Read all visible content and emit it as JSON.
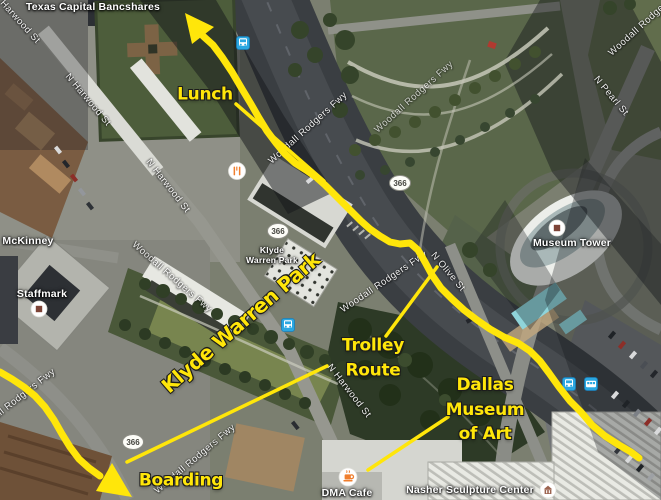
{
  "yellow_color": "#ffe60a",
  "annotations": {
    "labels": [
      {
        "id": "lunch-annotation",
        "text": "Lunch",
        "x": 205,
        "y": 95,
        "size": 17,
        "rot": 0
      },
      {
        "id": "klyde-warren-park-annotation",
        "text": "Klyde Warren Park",
        "x": 241,
        "y": 323,
        "size": 20,
        "rot": -41,
        "ls": -0.5
      },
      {
        "id": "trolley-route-annotation",
        "text": "Trolley\nRoute",
        "x": 373,
        "y": 358,
        "size": 17,
        "rot": 0
      },
      {
        "id": "dallas-museum-of-art-annotation",
        "text": "Dallas\nMuseum\nof Art",
        "x": 485,
        "y": 410,
        "size": 17,
        "rot": 0
      },
      {
        "id": "boarding-annotation",
        "text": "Boarding",
        "x": 181,
        "y": 481,
        "size": 17,
        "rot": 0
      }
    ],
    "routes": [
      {
        "id": "lunch-leader-line",
        "width": 3.5,
        "points": [
          [
            236,
            104
          ],
          [
            324,
            181
          ]
        ]
      },
      {
        "id": "trolley-route-line",
        "width": 3.5,
        "points": [
          [
            327,
            366
          ],
          [
            127,
            462
          ]
        ]
      },
      {
        "id": "trolley-leader-line",
        "width": 3.5,
        "points": [
          [
            437,
            267
          ],
          [
            386,
            336
          ]
        ]
      },
      {
        "id": "dma-leader-line",
        "width": 3.5,
        "points": [
          [
            448,
            417
          ],
          [
            368,
            470
          ]
        ]
      },
      {
        "id": "main-walking-route",
        "width": 7,
        "points": [
          [
            203,
            36
          ],
          [
            213,
            45
          ],
          [
            222,
            57
          ],
          [
            232,
            72
          ],
          [
            242,
            89
          ],
          [
            251,
            104
          ],
          [
            259,
            118
          ],
          [
            267,
            131
          ],
          [
            276,
            143
          ],
          [
            285,
            154
          ],
          [
            295,
            163
          ],
          [
            306,
            170
          ],
          [
            316,
            177
          ],
          [
            325,
            185
          ],
          [
            334,
            194
          ],
          [
            343,
            203
          ],
          [
            352,
            212
          ],
          [
            361,
            221
          ],
          [
            370,
            229
          ],
          [
            380,
            236
          ],
          [
            390,
            242
          ],
          [
            400,
            244
          ],
          [
            410,
            243
          ],
          [
            418,
            250
          ],
          [
            425,
            262
          ],
          [
            432,
            275
          ],
          [
            441,
            288
          ],
          [
            452,
            299
          ],
          [
            464,
            310
          ],
          [
            477,
            320
          ],
          [
            490,
            329
          ],
          [
            504,
            337
          ],
          [
            518,
            343
          ],
          [
            530,
            351
          ],
          [
            540,
            361
          ],
          [
            549,
            373
          ],
          [
            559,
            387
          ],
          [
            570,
            401
          ],
          [
            581,
            412
          ],
          [
            592,
            425
          ],
          [
            605,
            436
          ],
          [
            619,
            445
          ],
          [
            631,
            452
          ],
          [
            639,
            458
          ]
        ]
      },
      {
        "id": "boarding-route",
        "width": 7,
        "points": [
          [
            0,
            372
          ],
          [
            12,
            379
          ],
          [
            24,
            387
          ],
          [
            35,
            396
          ],
          [
            45,
            407
          ],
          [
            54,
            420
          ],
          [
            62,
            434
          ],
          [
            70,
            447
          ],
          [
            79,
            459
          ],
          [
            89,
            468
          ],
          [
            100,
            476
          ]
        ]
      }
    ],
    "arrowheads": [
      {
        "id": "north-arrowhead",
        "points": [
          [
            185,
            13
          ],
          [
            214,
            27
          ],
          [
            192,
            44
          ]
        ]
      },
      {
        "id": "boarding-arrowhead",
        "points": [
          [
            132,
            497
          ],
          [
            96,
            491
          ],
          [
            112,
            463
          ]
        ]
      }
    ]
  },
  "places": [
    {
      "id": "texas-capital-bancshares-label",
      "text": "Texas Capital Bancshares",
      "x": 93,
      "y": 7
    },
    {
      "id": "mckinney-label",
      "text": "McKinney",
      "x": 28,
      "y": 241
    },
    {
      "id": "staffmark-label",
      "text": "Staffmark",
      "x": 42,
      "y": 294
    },
    {
      "id": "klyde-warren-park-map-label",
      "text": "Klyde\nWarren Park",
      "x": 272,
      "y": 255,
      "size": 8.5
    },
    {
      "id": "museum-tower-label",
      "text": "Museum Tower",
      "x": 572,
      "y": 243
    },
    {
      "id": "dma-cafe-label",
      "text": "DMA Cafe",
      "x": 347,
      "y": 493
    },
    {
      "id": "nasher-sculpture-center-label",
      "text": "Nasher Sculpture Center",
      "x": 470,
      "y": 490
    }
  ],
  "streets": [
    {
      "id": "harwood-st-topleft",
      "text": "Harwood St",
      "x": 20,
      "y": 22,
      "rot": 48
    },
    {
      "id": "n-harwood-st-upper",
      "text": "N Harwood St",
      "x": 88,
      "y": 100,
      "rot": 50
    },
    {
      "id": "n-harwood-st-mid",
      "text": "N Harwood St",
      "x": 168,
      "y": 186,
      "rot": 52
    },
    {
      "id": "n-harwood-st-lower",
      "text": "N Harwood St",
      "x": 349,
      "y": 391,
      "rot": 52
    },
    {
      "id": "n-olive-st",
      "text": "N Olive St",
      "x": 448,
      "y": 272,
      "rot": 50
    },
    {
      "id": "n-pearl-st",
      "text": "N Pearl St",
      "x": 611,
      "y": 96,
      "rot": 50
    },
    {
      "id": "woodall-rodgers-fwy-upper",
      "text": "Woodall Rodgers Fwy",
      "x": 308,
      "y": 128,
      "rot": -42
    },
    {
      "id": "woodall-rodgers-fwy-park",
      "text": "Woodall Rodgers Fwy",
      "x": 414,
      "y": 97,
      "rot": -42,
      "opacity": 0.7
    },
    {
      "id": "woodall-rodgers-fwy-mid",
      "text": "Woodall Rodgers Fwy",
      "x": 384,
      "y": 282,
      "rot": -34
    },
    {
      "id": "woodall-rodgers-fwy-lower",
      "text": "Woodall Rodgers Fwy",
      "x": 195,
      "y": 459,
      "rot": -40
    },
    {
      "id": "woodall-rodgers-fwy-left-edge",
      "text": "Woodall Rodgers Fwy",
      "x": 14,
      "y": 402,
      "rot": -38
    },
    {
      "id": "woodall-rodgers-fwy-top-right",
      "text": "Woodall Rodgers Fwy",
      "x": 648,
      "y": 20,
      "rot": -42
    },
    {
      "id": "woodall-rodgers-fwy-west",
      "text": "Woodall Rodgers Fwy",
      "x": 172,
      "y": 277,
      "rot": 41,
      "opacity": 0.85
    }
  ],
  "shields": [
    {
      "id": "route-shield-366-a",
      "text": "366",
      "x": 278,
      "y": 231
    },
    {
      "id": "route-shield-366-b",
      "text": "366",
      "x": 400,
      "y": 183
    },
    {
      "id": "route-shield-366-c",
      "text": "366",
      "x": 133,
      "y": 442
    }
  ],
  "poi_icons": [
    {
      "id": "transit-station-icon-north",
      "type": "bus",
      "x": 243,
      "y": 43
    },
    {
      "id": "transit-station-icon-park",
      "type": "bus",
      "x": 288,
      "y": 325
    },
    {
      "id": "transit-station-icon-east-1",
      "type": "bus",
      "x": 569,
      "y": 384
    },
    {
      "id": "transit-station-icon-east-2",
      "type": "tram",
      "x": 591,
      "y": 384
    },
    {
      "id": "restaurant-icon",
      "type": "restaurant",
      "x": 237,
      "y": 171
    },
    {
      "id": "museum-tower-icon",
      "type": "building",
      "x": 557,
      "y": 228
    },
    {
      "id": "staffmark-icon",
      "type": "building",
      "x": 39,
      "y": 309
    },
    {
      "id": "dma-cafe-icon",
      "type": "cafe",
      "x": 348,
      "y": 477
    },
    {
      "id": "nasher-icon",
      "type": "museum",
      "x": 548,
      "y": 490
    }
  ]
}
